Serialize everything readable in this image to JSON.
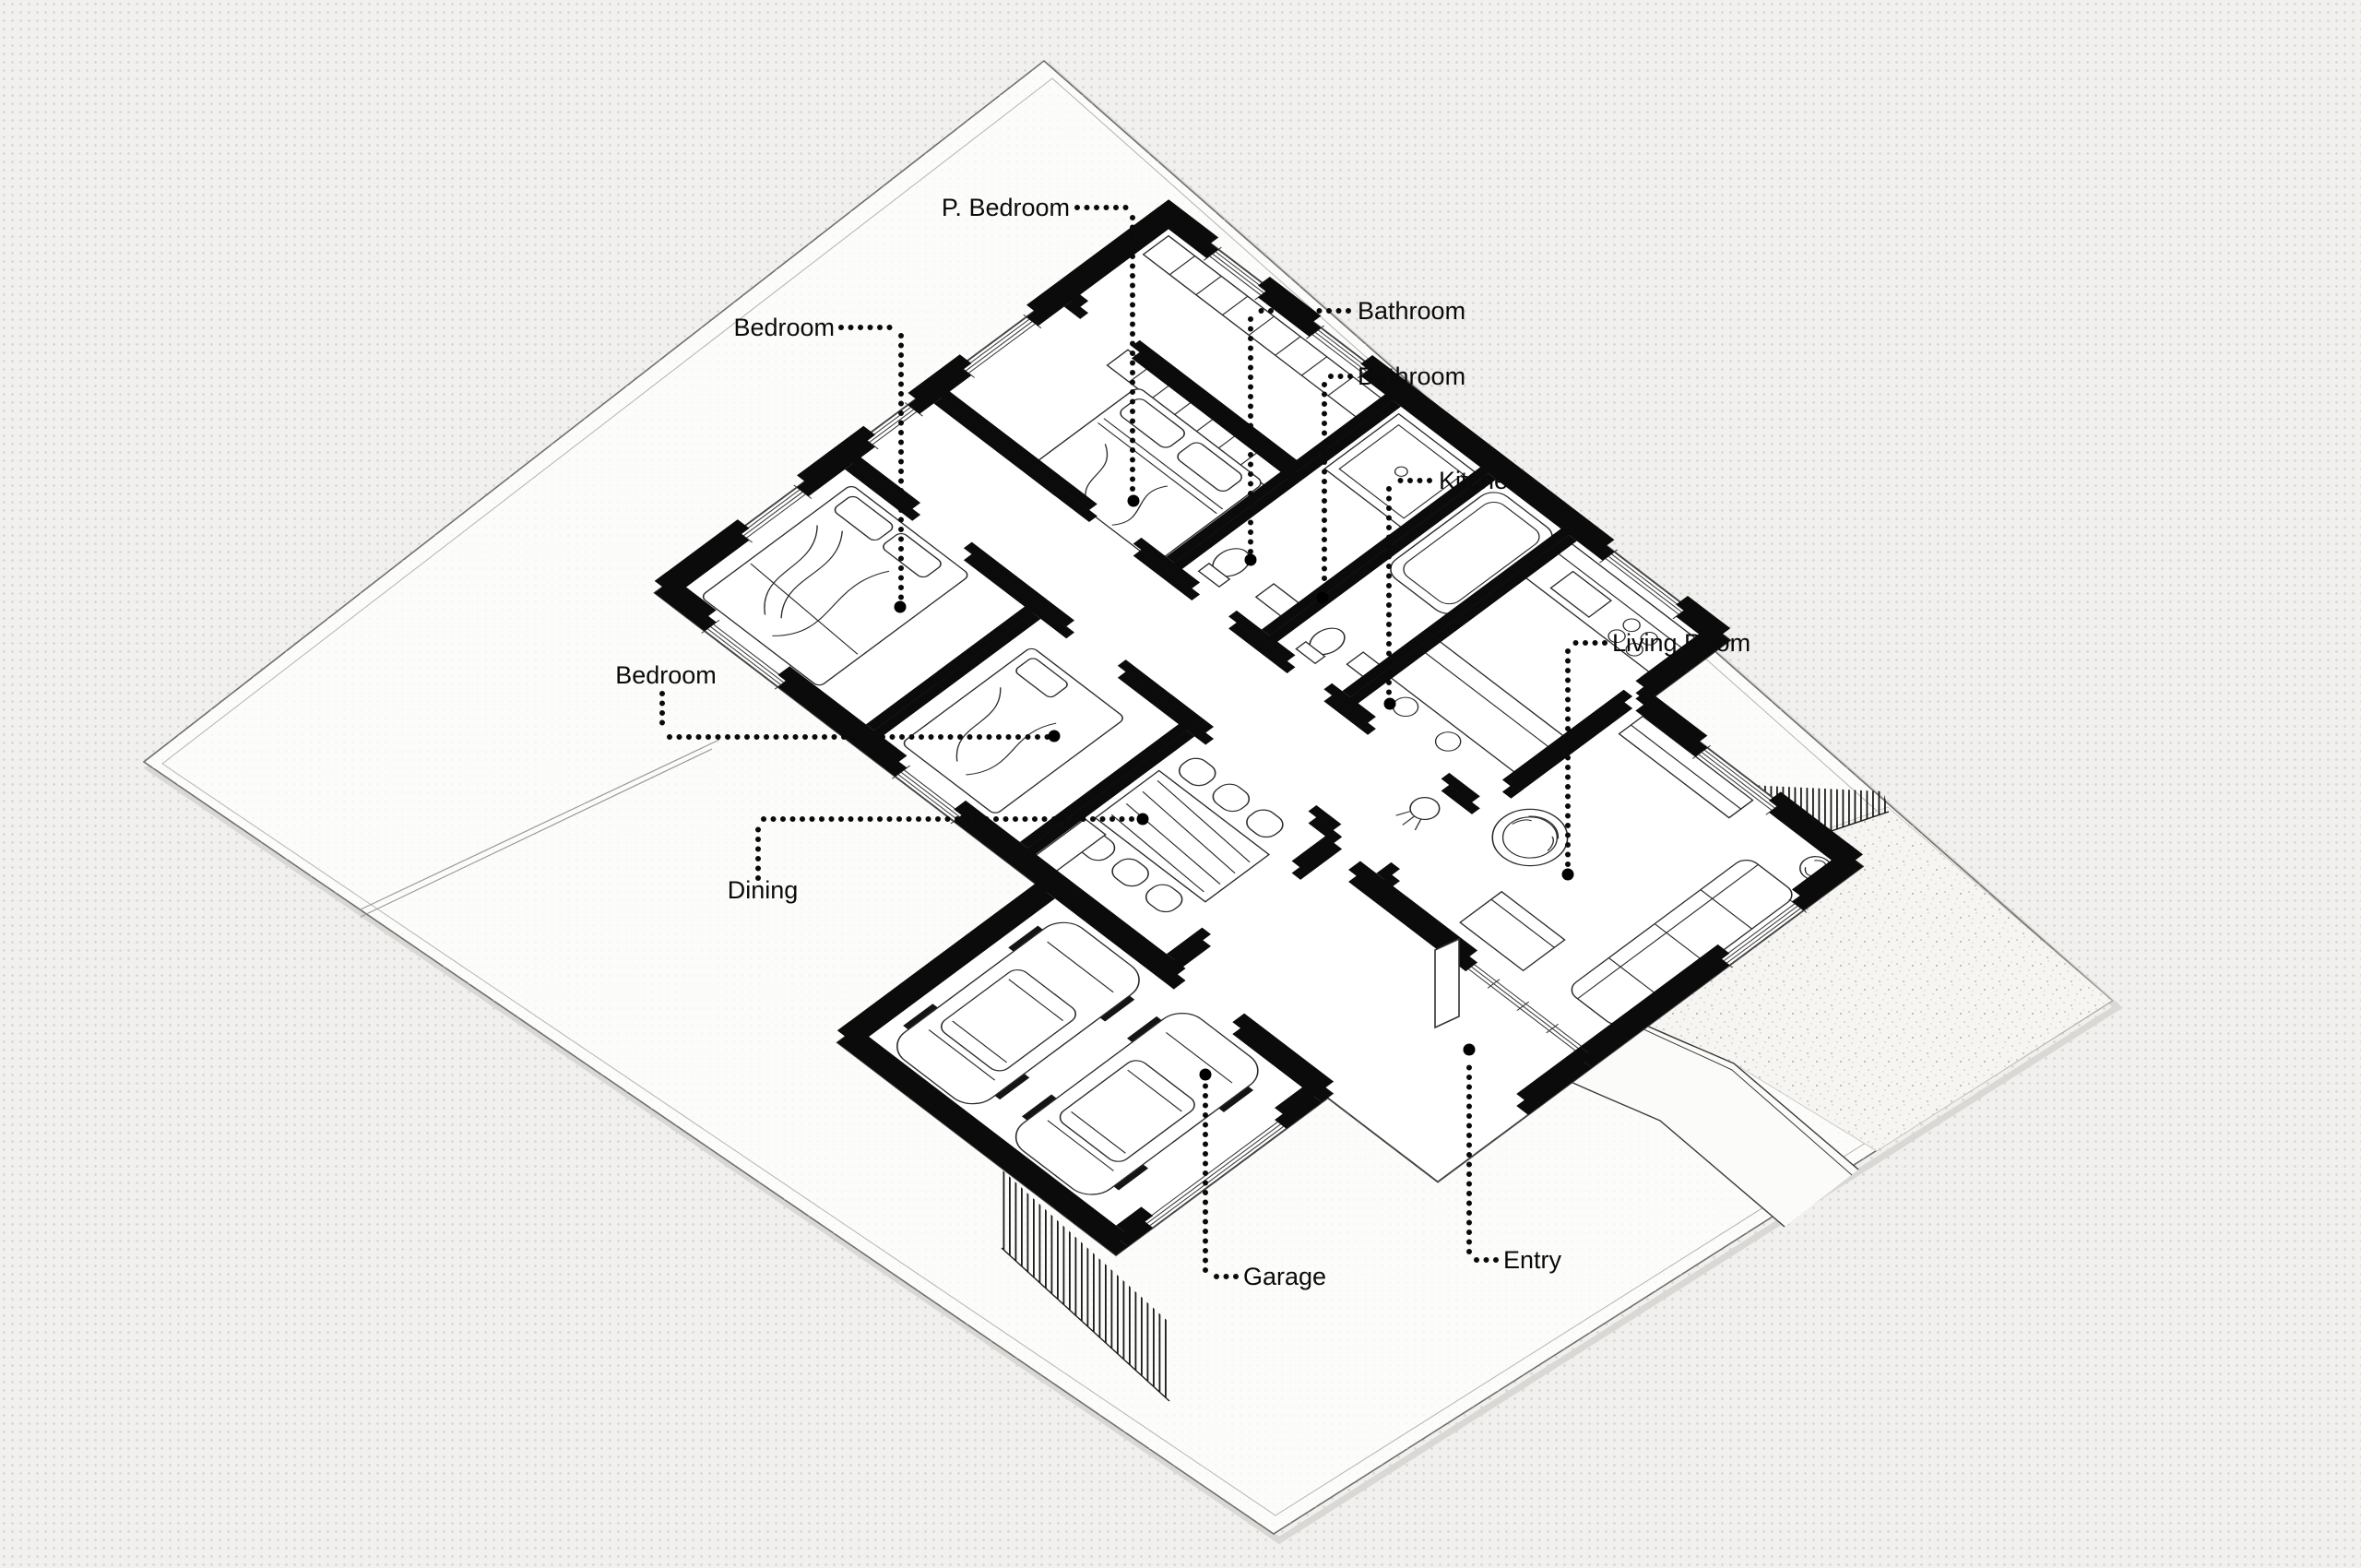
{
  "colors": {
    "background": "#f1f0ee",
    "halftone_dot": "#d7d6d2",
    "plot_fill": "#fcfcfb",
    "plot_faint_dot": "#eae9e6",
    "ink": "#0b0b0b",
    "boundary_gray": "#8a8a88",
    "stipple_speck": "#b9b7b2",
    "stipple_ground": "#f6f5f2"
  },
  "labels": [
    {
      "id": "p-bedroom",
      "text": "P. Bedroom"
    },
    {
      "id": "bathroom-1",
      "text": "Bathroom"
    },
    {
      "id": "bathroom-2",
      "text": "Bathroom"
    },
    {
      "id": "kitchen",
      "text": "Kitchen"
    },
    {
      "id": "living-room",
      "text": "Living Room"
    },
    {
      "id": "bedroom-1",
      "text": "Bedroom"
    },
    {
      "id": "bedroom-2",
      "text": "Bedroom"
    },
    {
      "id": "dining",
      "text": "Dining"
    },
    {
      "id": "garage",
      "text": "Garage"
    },
    {
      "id": "entry",
      "text": "Entry"
    }
  ]
}
